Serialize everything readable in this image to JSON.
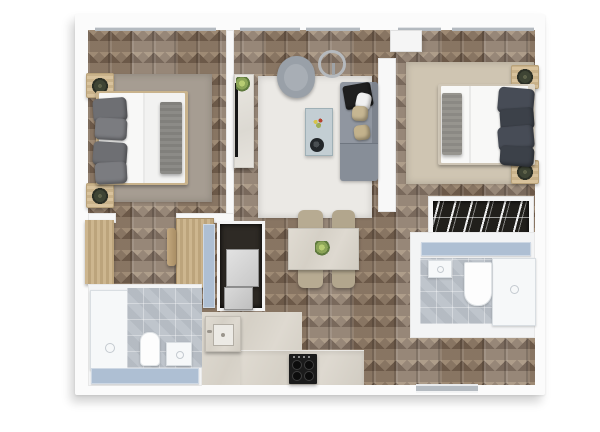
{
  "scene": {
    "type": "apartment-floor-plan-3d-top-view",
    "style": "photorealistic render, no text labels",
    "background": "#ffffff"
  },
  "palette": {
    "wall": "#fbfbfb",
    "wall_shade": "#e6e6e6",
    "wood_floor_base": "#8b7a6a",
    "wood_floor_dark": "#6a594b",
    "wood_floor_light": "#a5937f",
    "window_sill": "#b4bac0",
    "accent_blue_gray": "#aebfd3",
    "tile_floor": "#bfc5cc",
    "stone_counter": "#d9d4cb",
    "sofa_gray": "#9096a0",
    "armchair_gray": "#99a0a8",
    "cushion_beige": "#c6b692",
    "throw_black": "#1f1f1f",
    "bed_white": "#f8f8f7",
    "pillow_gray": "#6e6f73",
    "pillow_dark_slate": "#474c56",
    "bed_frame_wood": "#c9b38c",
    "nightstand_wood": "#d2bc96",
    "rug_bedroom_left": "#a69d92",
    "rug_living": "#ebe9e5",
    "rug_bedroom_right": "#cfc5b2",
    "closet_dark": "#2e2a25",
    "wardrobe_interior": "#211f1b",
    "appliance_gray": "#d9d9d9",
    "cooktop_black": "#1b1b1b",
    "plant_green": "#8ba457",
    "threshold_gray": "#b6bcc2"
  },
  "rooms": [
    {
      "name": "bedroom-left",
      "furniture": [
        "double-bed",
        "bed-pillows",
        "blanket-runner",
        "nightstand-with-plant",
        "nightstand-with-plant",
        "area-rug"
      ]
    },
    {
      "name": "living-room",
      "furniture": [
        "corner-sofa",
        "black-throw",
        "white-pillow",
        "beige-cushions",
        "armchair",
        "arc-floor-lamp",
        "glass-coffee-table",
        "decor-bowl",
        "tv-console",
        "potted-plant",
        "area-rug"
      ]
    },
    {
      "name": "bedroom-right",
      "furniture": [
        "double-bed",
        "bed-pillows",
        "blanket-runner",
        "nightstand-with-plant",
        "nightstand-with-plant",
        "area-rug"
      ]
    },
    {
      "name": "dressing-area",
      "furniture": [
        "open-wardrobe-hanging-clothes"
      ]
    },
    {
      "name": "bathroom-right",
      "furniture": [
        "vanity-counter",
        "shower",
        "toilet",
        "washbasin",
        "tiled-floor"
      ]
    },
    {
      "name": "bathroom-left",
      "furniture": [
        "shower",
        "toilet",
        "washbasin",
        "vanity-counter",
        "tiled-floor"
      ]
    },
    {
      "name": "kitchen",
      "furniture": [
        "stone-floor",
        "worktop",
        "cooktop-4-burners",
        "kitchen-sink-unit"
      ]
    },
    {
      "name": "dining-area",
      "furniture": [
        "stone-dining-table",
        "dining-chair",
        "dining-chair",
        "dining-chair",
        "dining-chair",
        "table-plant"
      ]
    },
    {
      "name": "hallway",
      "furniture": [
        "wardrobe-cabinet",
        "wardrobe-cabinet",
        "cabinet-door",
        "utility-closet",
        "washing-machine",
        "dryer",
        "utility-door-panel"
      ]
    },
    {
      "name": "entrance",
      "furniture": [
        "door-threshold"
      ]
    }
  ],
  "windows": {
    "count": 5,
    "location": "top exterior wall"
  },
  "doors": {
    "interior_door_leaf": "bedroom-right",
    "entry": "bottom-right threshold"
  }
}
